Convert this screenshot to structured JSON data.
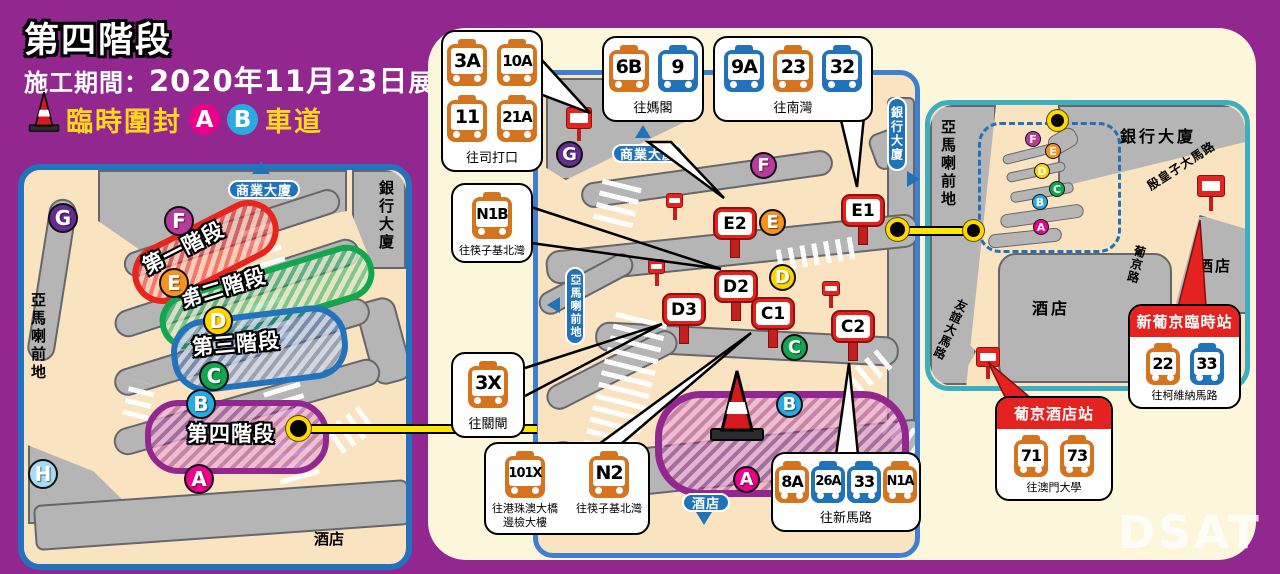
{
  "header": {
    "title": "第四階段",
    "period_label": "施工期間：",
    "period_date": "2020年11月23日",
    "period_suffix": "展開",
    "closure_label": "臨時圍封",
    "lane_a": "A",
    "lane_b": "B",
    "closure_suffix": "車道"
  },
  "left_map": {
    "labels": {
      "top": "商業大廈",
      "right": "銀行大廈",
      "left": "亞馬喇前地",
      "bottom": "酒店"
    },
    "phases": [
      {
        "name": "第一階段",
        "color": "#E8251D"
      },
      {
        "name": "第二階段",
        "color": "#12A64E"
      },
      {
        "name": "第三階段",
        "color": "#2273BE"
      },
      {
        "name": "第四階段",
        "color": "#92278F"
      }
    ],
    "markers": [
      {
        "letter": "G",
        "color": "#662D91"
      },
      {
        "letter": "F",
        "color": "#B93A9C"
      },
      {
        "letter": "E",
        "color": "#F6921E"
      },
      {
        "letter": "D",
        "color": "#FFD400"
      },
      {
        "letter": "C",
        "color": "#12A651"
      },
      {
        "letter": "B",
        "color": "#29ABE2"
      },
      {
        "letter": "A",
        "color": "#EC008C"
      },
      {
        "letter": "H",
        "color": "#A6DBF7"
      }
    ]
  },
  "middle_map": {
    "labels": {
      "top": "商業大廈",
      "right": "銀行大廈",
      "left": "亞馬喇前地",
      "bottom": "酒店"
    },
    "letters": [
      "G",
      "F",
      "E",
      "D",
      "C",
      "B",
      "A"
    ],
    "stops": [
      "E1",
      "E2",
      "D2",
      "D3",
      "C1",
      "C2"
    ]
  },
  "right_map": {
    "labels": {
      "left": "亞馬喇前地",
      "bank": "銀行大廈",
      "road_infante": "殷皇子大馬路",
      "road_lisboa": "葡京路",
      "road_amizade": "友誼大馬路",
      "hotel_center": "酒店",
      "hotel_right": "酒店"
    },
    "letters": [
      "F",
      "E",
      "D",
      "C",
      "B",
      "A"
    ]
  },
  "callouts": {
    "sidatou": {
      "dest": "往司打口",
      "routes": [
        {
          "no": "3A",
          "color": "orange"
        },
        {
          "no": "10A",
          "color": "orange"
        },
        {
          "no": "11",
          "color": "orange"
        },
        {
          "no": "21A",
          "color": "orange"
        }
      ]
    },
    "magang": {
      "dest": "往媽閣",
      "routes": [
        {
          "no": "6B",
          "color": "orange"
        },
        {
          "no": "9",
          "color": "blue"
        }
      ]
    },
    "nanwan": {
      "dest": "往南灣",
      "routes": [
        {
          "no": "9A",
          "color": "blue"
        },
        {
          "no": "23",
          "color": "orange"
        },
        {
          "no": "32",
          "color": "blue"
        }
      ]
    },
    "n1b": {
      "dest": "往筷子基北灣",
      "routes": [
        {
          "no": "N1B",
          "color": "orange"
        }
      ]
    },
    "x3": {
      "dest": "往關閘",
      "routes": [
        {
          "no": "3X",
          "color": "orange"
        }
      ]
    },
    "night": {
      "routes": [
        {
          "no": "101X",
          "color": "orange",
          "dest_line1": "往港珠澳大橋",
          "dest_line2": "邊檢大樓"
        },
        {
          "no": "N2",
          "color": "orange",
          "dest_line1": "往筷子基北灣",
          "dest_line2": ""
        }
      ]
    },
    "xinmalu": {
      "dest": "往新馬路",
      "routes": [
        {
          "no": "8A",
          "color": "orange"
        },
        {
          "no": "26A",
          "color": "blue"
        },
        {
          "no": "33",
          "color": "blue"
        },
        {
          "no": "N1A",
          "color": "orange"
        }
      ]
    },
    "grand_lisboa": {
      "station": "新葡京臨時站",
      "dest": "往柯維納馬路",
      "routes": [
        {
          "no": "22",
          "color": "orange"
        },
        {
          "no": "33",
          "color": "blue"
        }
      ]
    },
    "lisboa_hotel": {
      "station": "葡京酒店站",
      "dest": "往澳門大學",
      "routes": [
        {
          "no": "71",
          "color": "orange"
        },
        {
          "no": "73",
          "color": "orange"
        }
      ]
    }
  },
  "watermark": "DSAT",
  "colors": {
    "background": "#92278F",
    "panel_cream": "#FCF6DB",
    "map_tan": "#FAE3C1",
    "road_gray": "#B5B5B6",
    "accent_yellow": "#FFE600",
    "bus_orange": "#D4741F",
    "bus_blue": "#2173B9",
    "stop_red": "#E42320",
    "border_blue": "#2173BE",
    "border_teal": "#3CAEC0"
  }
}
